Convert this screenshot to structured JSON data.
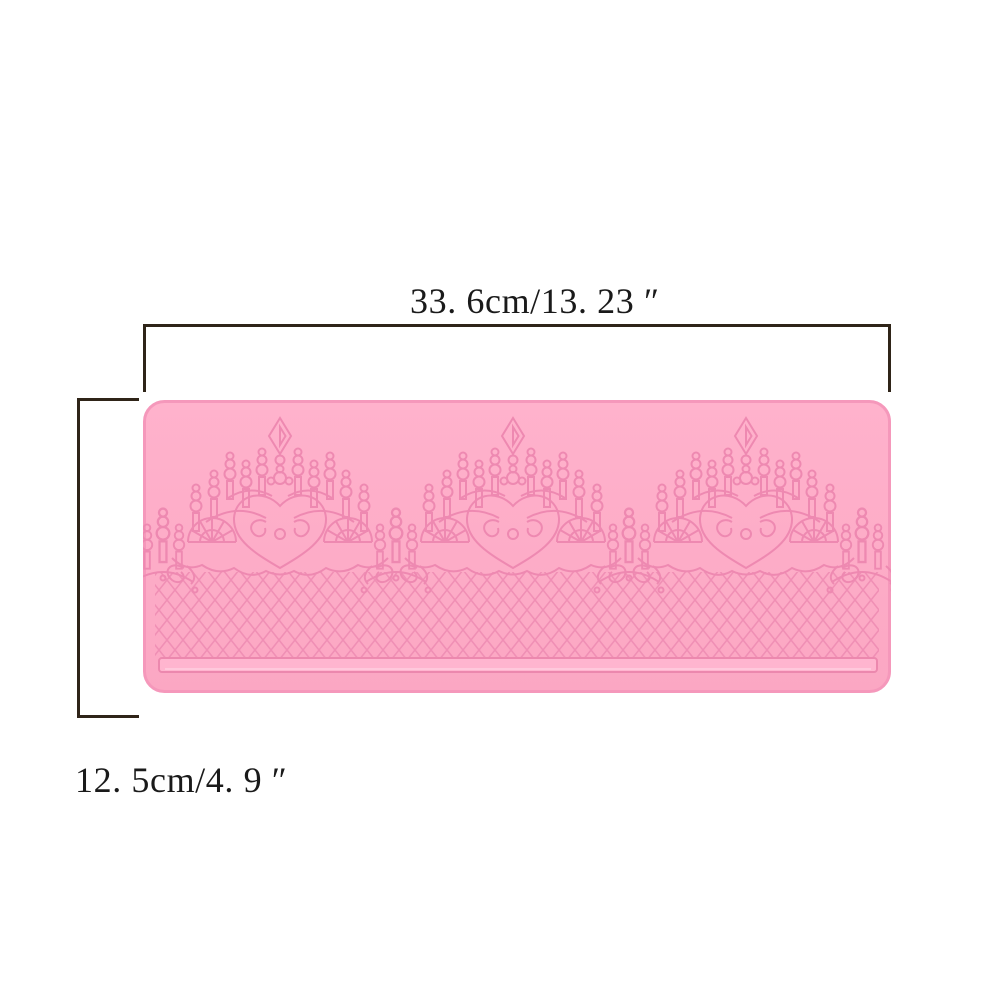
{
  "annotations": {
    "width_label": "33. 6cm/13. 23 ″",
    "height_label": "12. 5cm/4. 9 ″",
    "line_color": "#2f2418",
    "text_color": "#1a1a1a"
  },
  "mold": {
    "base_color": "#fcaac6",
    "base_color_light": "#ffb4ce",
    "pattern_color": "#ee89b1",
    "lattice_color": "#f08fb5",
    "edge_color": "#f598bb",
    "groove_fill": "#ffb5cf",
    "groove_stroke": "#ec88ae",
    "background_color": "#ffffff"
  }
}
